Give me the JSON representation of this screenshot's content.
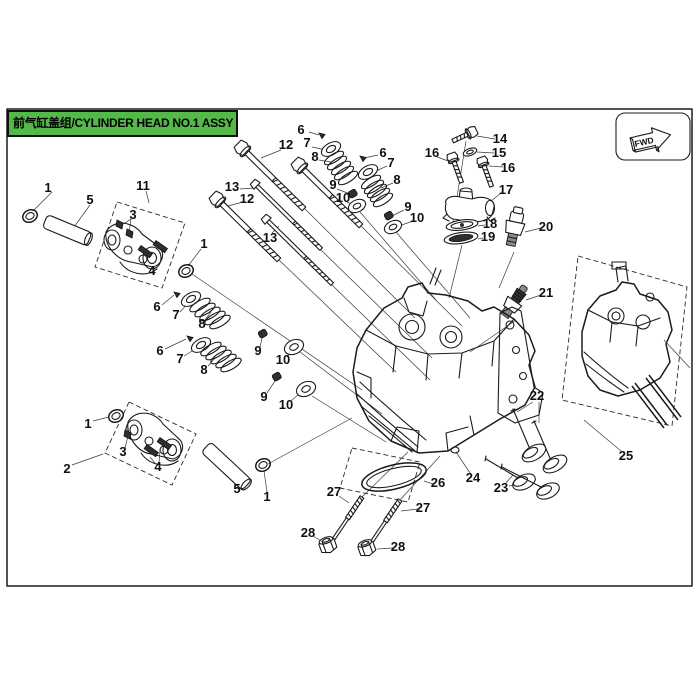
{
  "title": {
    "zh": "前气缸盖组",
    "en": "CYLINDER HEAD NO.1 ASSY",
    "full": "前气缸盖组/CYLINDER HEAD NO.1 ASSY"
  },
  "fwd_label": "FWD",
  "colors": {
    "banner_green": "#53b948",
    "line": "#1b1b1b",
    "background": "#ffffff"
  },
  "callouts": [
    {
      "n": "1",
      "x": 48,
      "y": 188
    },
    {
      "n": "5",
      "x": 90,
      "y": 200
    },
    {
      "n": "11",
      "x": 143,
      "y": 186
    },
    {
      "n": "3",
      "x": 133,
      "y": 215
    },
    {
      "n": "4",
      "x": 152,
      "y": 271
    },
    {
      "n": "1",
      "x": 204,
      "y": 244
    },
    {
      "n": "13",
      "x": 232,
      "y": 187
    },
    {
      "n": "12",
      "x": 286,
      "y": 145
    },
    {
      "n": "12",
      "x": 247,
      "y": 199
    },
    {
      "n": "13",
      "x": 270,
      "y": 238
    },
    {
      "n": "6",
      "x": 301,
      "y": 130
    },
    {
      "n": "7",
      "x": 307,
      "y": 143
    },
    {
      "n": "8",
      "x": 315,
      "y": 157
    },
    {
      "n": "9",
      "x": 333,
      "y": 185
    },
    {
      "n": "10",
      "x": 343,
      "y": 198
    },
    {
      "n": "6",
      "x": 383,
      "y": 153
    },
    {
      "n": "7",
      "x": 391,
      "y": 163
    },
    {
      "n": "8",
      "x": 397,
      "y": 180
    },
    {
      "n": "9",
      "x": 408,
      "y": 207
    },
    {
      "n": "10",
      "x": 417,
      "y": 218
    },
    {
      "n": "16",
      "x": 432,
      "y": 153
    },
    {
      "n": "14",
      "x": 500,
      "y": 139
    },
    {
      "n": "15",
      "x": 499,
      "y": 153
    },
    {
      "n": "16",
      "x": 508,
      "y": 168
    },
    {
      "n": "17",
      "x": 506,
      "y": 190
    },
    {
      "n": "18",
      "x": 490,
      "y": 224
    },
    {
      "n": "19",
      "x": 488,
      "y": 237
    },
    {
      "n": "20",
      "x": 546,
      "y": 227
    },
    {
      "n": "21",
      "x": 546,
      "y": 293
    },
    {
      "n": "6",
      "x": 157,
      "y": 307
    },
    {
      "n": "7",
      "x": 176,
      "y": 315
    },
    {
      "n": "8",
      "x": 202,
      "y": 324
    },
    {
      "n": "6",
      "x": 160,
      "y": 351
    },
    {
      "n": "7",
      "x": 180,
      "y": 359
    },
    {
      "n": "8",
      "x": 204,
      "y": 370
    },
    {
      "n": "9",
      "x": 258,
      "y": 351
    },
    {
      "n": "10",
      "x": 283,
      "y": 360
    },
    {
      "n": "9",
      "x": 264,
      "y": 397
    },
    {
      "n": "10",
      "x": 286,
      "y": 405
    },
    {
      "n": "1",
      "x": 88,
      "y": 424
    },
    {
      "n": "2",
      "x": 67,
      "y": 469
    },
    {
      "n": "3",
      "x": 123,
      "y": 452
    },
    {
      "n": "4",
      "x": 158,
      "y": 467
    },
    {
      "n": "5",
      "x": 237,
      "y": 489
    },
    {
      "n": "1",
      "x": 267,
      "y": 497
    },
    {
      "n": "22",
      "x": 537,
      "y": 396
    },
    {
      "n": "25",
      "x": 626,
      "y": 456
    },
    {
      "n": "24",
      "x": 473,
      "y": 478
    },
    {
      "n": "23",
      "x": 501,
      "y": 488
    },
    {
      "n": "26",
      "x": 438,
      "y": 483
    },
    {
      "n": "27",
      "x": 334,
      "y": 492
    },
    {
      "n": "27",
      "x": 423,
      "y": 508
    },
    {
      "n": "28",
      "x": 308,
      "y": 533
    },
    {
      "n": "28",
      "x": 398,
      "y": 547
    }
  ]
}
